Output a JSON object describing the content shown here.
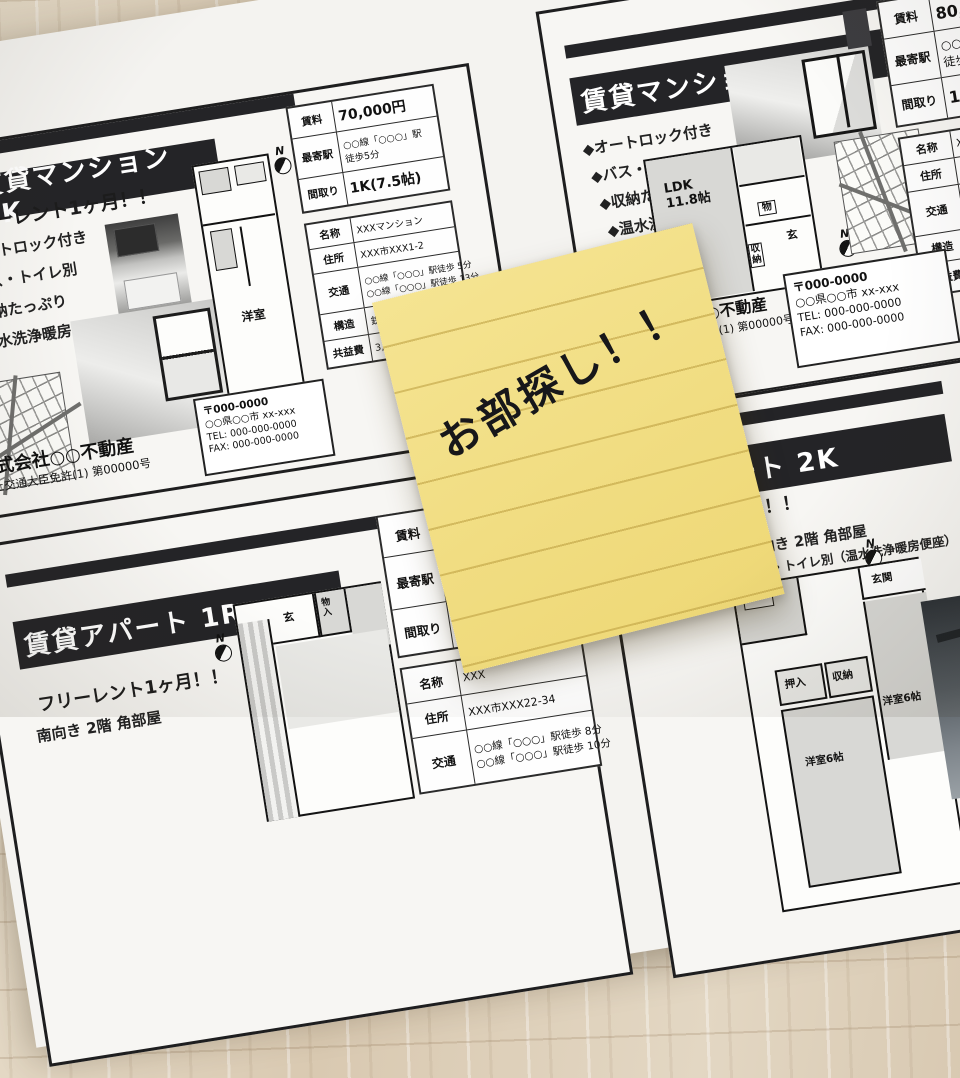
{
  "note": {
    "text": "お部探し！！"
  },
  "flyers": {
    "k1": {
      "title": "賃貸マンション 1K",
      "promo": "フリーレント1ヶ月！！",
      "features": [
        "オートロック付き",
        "バス・トイレ別",
        "収納たっぷり",
        "温水洗浄暖房便座"
      ],
      "north": "N",
      "plan": {
        "room": "洋室"
      },
      "table": {
        "rent_label": "賃料",
        "rent": "70,000円",
        "station_label": "最寄駅",
        "station1": "○○線「○○○」駅",
        "station2": "徒歩5分",
        "layout_label": "間取り",
        "layout": "1K(7.5帖)",
        "name_label": "名称",
        "name": "XXXマンション",
        "addr_label": "住所",
        "addr": "XXX市XXX1-2",
        "transit_label": "交通",
        "transit1": "○○線「○○○」駅徒歩 5分",
        "transit2": "○○線「○○○」駅徒歩 13分",
        "structure_label": "構造",
        "structure": "鉄骨造3階建 3階",
        "fee_label": "共益費",
        "fee": "3,000円 / 月"
      },
      "company": "株式会社○○不動産",
      "license": "国土交通大臣免許(1) 第00000号",
      "contact": {
        "postal": "〒000-0000",
        "address": "○○県○○市 xx-xxx",
        "tel": "TEL: 000-000-0000",
        "fax": "FAX: 000-000-0000"
      }
    },
    "ldk1": {
      "title": "賃貸マンション 1LDK",
      "features": [
        "◆オートロック付き",
        "◆バス・トイレ別",
        "◆収納たっぷり",
        "◆温水洗浄暖房便座"
      ],
      "north": "N",
      "plan": {
        "ldk": "LDK\n11.8帖",
        "closet": "物",
        "entrance": "玄",
        "storage": "収納"
      },
      "table": {
        "rent_label": "賃料",
        "rent": "80,000円",
        "station_label": "最寄駅",
        "station1": "○○線「○○○」駅",
        "station2": "徒歩1分",
        "layout_label": "間取り",
        "layout": "1LDK",
        "name_label": "名称",
        "name": "XXX",
        "addr_label": "住所",
        "addr": "XXX",
        "transit_label": "交通",
        "transit1": "",
        "transit2": "",
        "structure_label": "構造",
        "structure": "",
        "fee_label": "共益費",
        "fee": ""
      },
      "company": "株式会社○○不動産",
      "license": "国土交通大臣免許(1) 第00000号",
      "contact": {
        "postal": "〒000-0000",
        "address": "○○県○○市 xx-xxx",
        "tel": "TEL: 000-000-0000",
        "fax": "FAX: 000-000-0000"
      }
    },
    "r1": {
      "title": "賃貸アパート 1R",
      "promo": "フリーレント1ヶ月！！",
      "line2": "南向き 2階 角部屋",
      "north": "N",
      "plan": {
        "entrance": "玄",
        "closet": "物入"
      },
      "table": {
        "rent_label": "賃料",
        "rent": "",
        "station_label": "最寄駅",
        "station1": "",
        "station2": "",
        "layout_label": "間取り",
        "layout": "1",
        "name_label": "名称",
        "name": "XXX",
        "addr_label": "住所",
        "addr": "XXX市XXX22-34",
        "transit_label": "交通",
        "transit1": "○○線「○○○」駅徒歩 8分",
        "transit2": "○○線「○○○」駅徒歩 10分"
      }
    },
    "k2": {
      "title": "賃貸アパート 2K",
      "promo": "フリーレント1ヶ月！！",
      "line2": "南向き 2階 角部屋",
      "line3": "バス・トイレ別（温水洗浄暖房便座）",
      "north": "N",
      "plan": {
        "entrance": "玄関",
        "oshiire": "押入",
        "storage": "収納",
        "room1": "洋室6帖",
        "room2": "洋室6帖"
      }
    }
  }
}
